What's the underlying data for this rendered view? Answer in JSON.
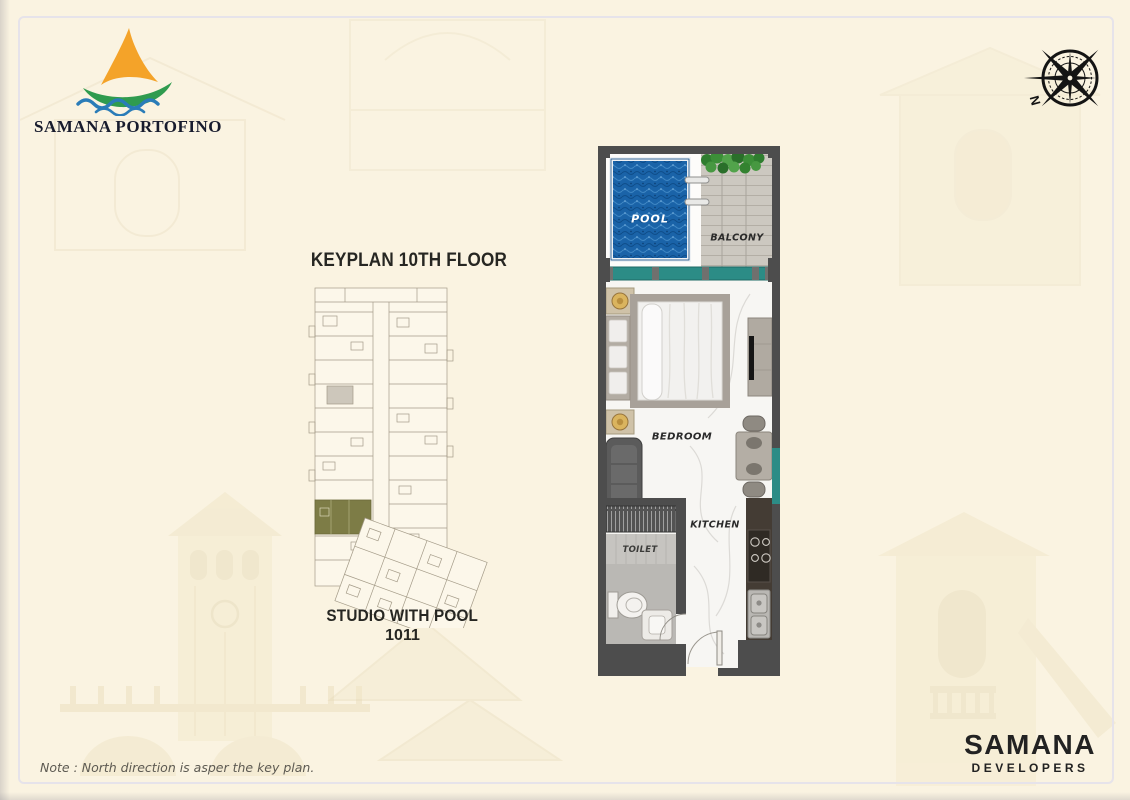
{
  "page": {
    "background": "#faf3e1",
    "frame_color": "#e6e3ea"
  },
  "logo": {
    "title": "SAMANA PORTOFINO",
    "sail_color": "#f4a329",
    "hull_color": "#2f9b4f",
    "wave_color": "#2a7cb8",
    "text_color": "#171b2d"
  },
  "compass": {
    "label": "N",
    "color": "#141414"
  },
  "keyplan": {
    "title": "KEYPLAN 10TH FLOOR",
    "caption_line1": "STUDIO WITH POOL",
    "caption_line2": "1011",
    "highlight_color": "#7d7c46",
    "line_color": "#a49b88"
  },
  "floorplan": {
    "wall_color": "#4d4d4d",
    "pool_color": "#1a63a8",
    "glass_color": "#2c8c86",
    "labels": {
      "pool": "POOL",
      "balcony": "BALCONY",
      "bedroom": "BEDROOM",
      "kitchen": "KITCHEN",
      "toilet": "TOILET"
    }
  },
  "note": {
    "text": "Note : North direction is asper the key plan."
  },
  "developer": {
    "name": "SAMANA",
    "subtitle": "DEVELOPERS"
  }
}
